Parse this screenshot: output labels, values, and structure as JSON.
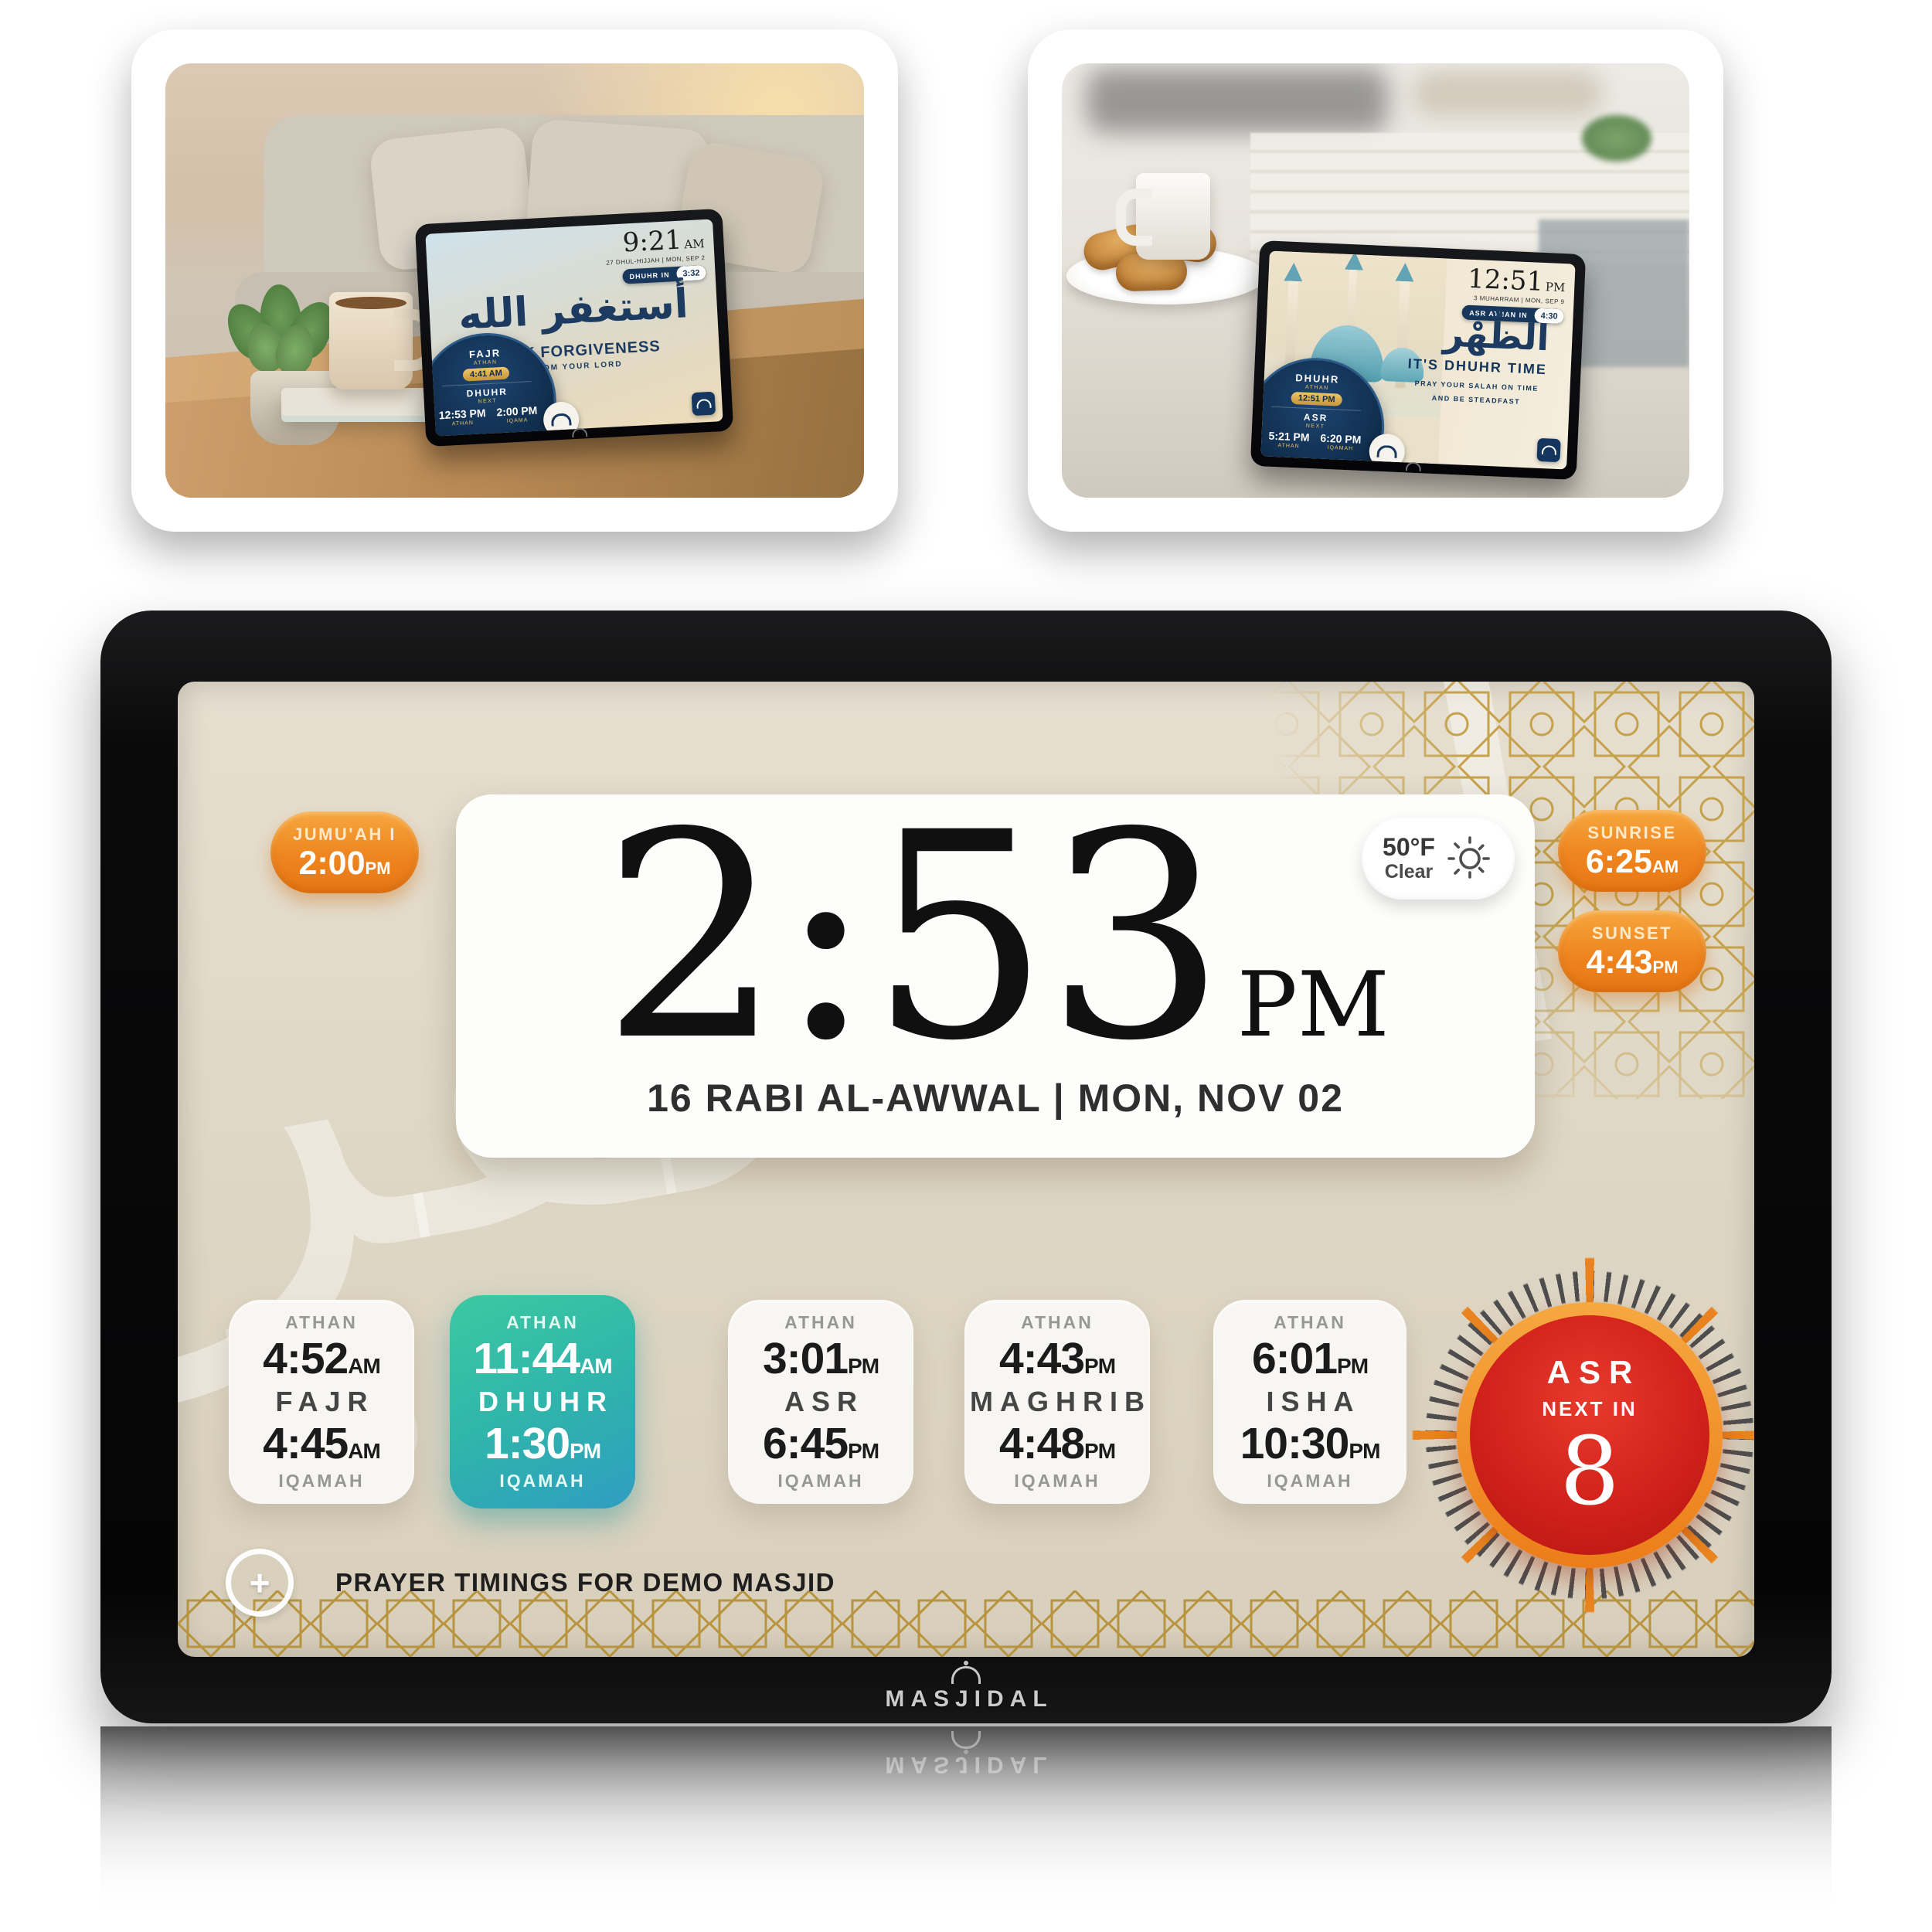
{
  "colors": {
    "accent_orange": "#ee851f",
    "teal_card_top": "#3cc9a1",
    "teal_card_bottom": "#2f9dc2",
    "countdown_red": "#d0201a",
    "countdown_ring_orange": "#ec7d18",
    "gold_pattern": "#c5a24b",
    "screen_beige": "#ded6c4",
    "navy": "#16365c"
  },
  "icons": {
    "sun_icon": "sun-with-rays",
    "plus_icon": "+",
    "masjidal_logo_icon": "mosque-dome",
    "ornament_icon": "calligraphy-seal"
  },
  "gallery": {
    "photo1": {
      "screen": {
        "time": "9:21",
        "meridiem": "AM",
        "date_line": "27 DHUL-HIJJAH | MON, SEP 2",
        "countdown_label": "DHUHR IN",
        "countdown_value": "3:32",
        "calligraphy": "أستغفر الله",
        "headline": "SEEK FORGIVENESS",
        "subline": "FROM YOUR LORD",
        "widget": {
          "top_label": "FAJR",
          "top_sub": "ATHAN",
          "badge": "4:41 AM",
          "mid_label": "DHUHR",
          "mid_sub": "NEXT",
          "athan_time": "12:53 PM",
          "athan_label": "ATHAN",
          "iqamah_time": "2:00 PM",
          "iqamah_label": "IQAMA"
        }
      }
    },
    "photo2": {
      "screen": {
        "time": "12:51",
        "meridiem": "PM",
        "date_line": "3 MUHARRAM | MON, SEP 9",
        "countdown_label": "ASR ATHAN IN",
        "countdown_value": "4:30",
        "calligraphy": "الظُهْر",
        "headline": "IT'S DHUHR TIME",
        "subline1": "PRAY YOUR SALAH ON TIME",
        "subline2": "AND BE STEADFAST",
        "widget": {
          "top_label": "DHUHR",
          "top_sub": "ATHAN",
          "badge": "12:51 PM",
          "mid_label": "ASR",
          "mid_sub": "NEXT",
          "athan_time": "5:21 PM",
          "athan_label": "ATHAN",
          "iqamah_time": "6:20 PM",
          "iqamah_label": "IQAMAH"
        }
      }
    }
  },
  "device": {
    "brand": "MASJIDAL",
    "background": {
      "watermark": "استغفر",
      "watermark2": "ثنا"
    },
    "jumuah": {
      "label": "JUMU'AH I",
      "time": "2:00",
      "meridiem": "PM"
    },
    "weather": {
      "temp": "50°F",
      "condition": "Clear"
    },
    "sunrise": {
      "label": "SUNRISE",
      "time": "6:25",
      "meridiem": "AM"
    },
    "sunset": {
      "label": "SUNSET",
      "time": "4:43",
      "meridiem": "PM"
    },
    "clock": {
      "time": "2:53",
      "meridiem": "PM",
      "date_line": "16 RABI AL-AWWAL | MON, NOV 02"
    },
    "labels": {
      "athan": "ATHAN",
      "iqamah": "IQAMAH"
    },
    "prayers": [
      {
        "name": "FAJR",
        "athan": "4:52",
        "athan_mer": "AM",
        "iqamah": "4:45",
        "iqamah_mer": "AM",
        "highlighted": false
      },
      {
        "name": "DHUHR",
        "athan": "11:44",
        "athan_mer": "AM",
        "iqamah": "1:30",
        "iqamah_mer": "PM",
        "highlighted": true
      },
      {
        "name": "ASR",
        "athan": "3:01",
        "athan_mer": "PM",
        "iqamah": "6:45",
        "iqamah_mer": "PM",
        "highlighted": false
      },
      {
        "name": "MAGHRIB",
        "athan": "4:43",
        "athan_mer": "PM",
        "iqamah": "4:48",
        "iqamah_mer": "PM",
        "highlighted": false
      },
      {
        "name": "ISHA",
        "athan": "6:01",
        "athan_mer": "PM",
        "iqamah": "10:30",
        "iqamah_mer": "PM",
        "highlighted": false
      }
    ],
    "countdown": {
      "prayer": "ASR",
      "label": "NEXT IN",
      "value": "8"
    },
    "footer_text": "PRAYER TIMINGS FOR DEMO MASJID"
  }
}
